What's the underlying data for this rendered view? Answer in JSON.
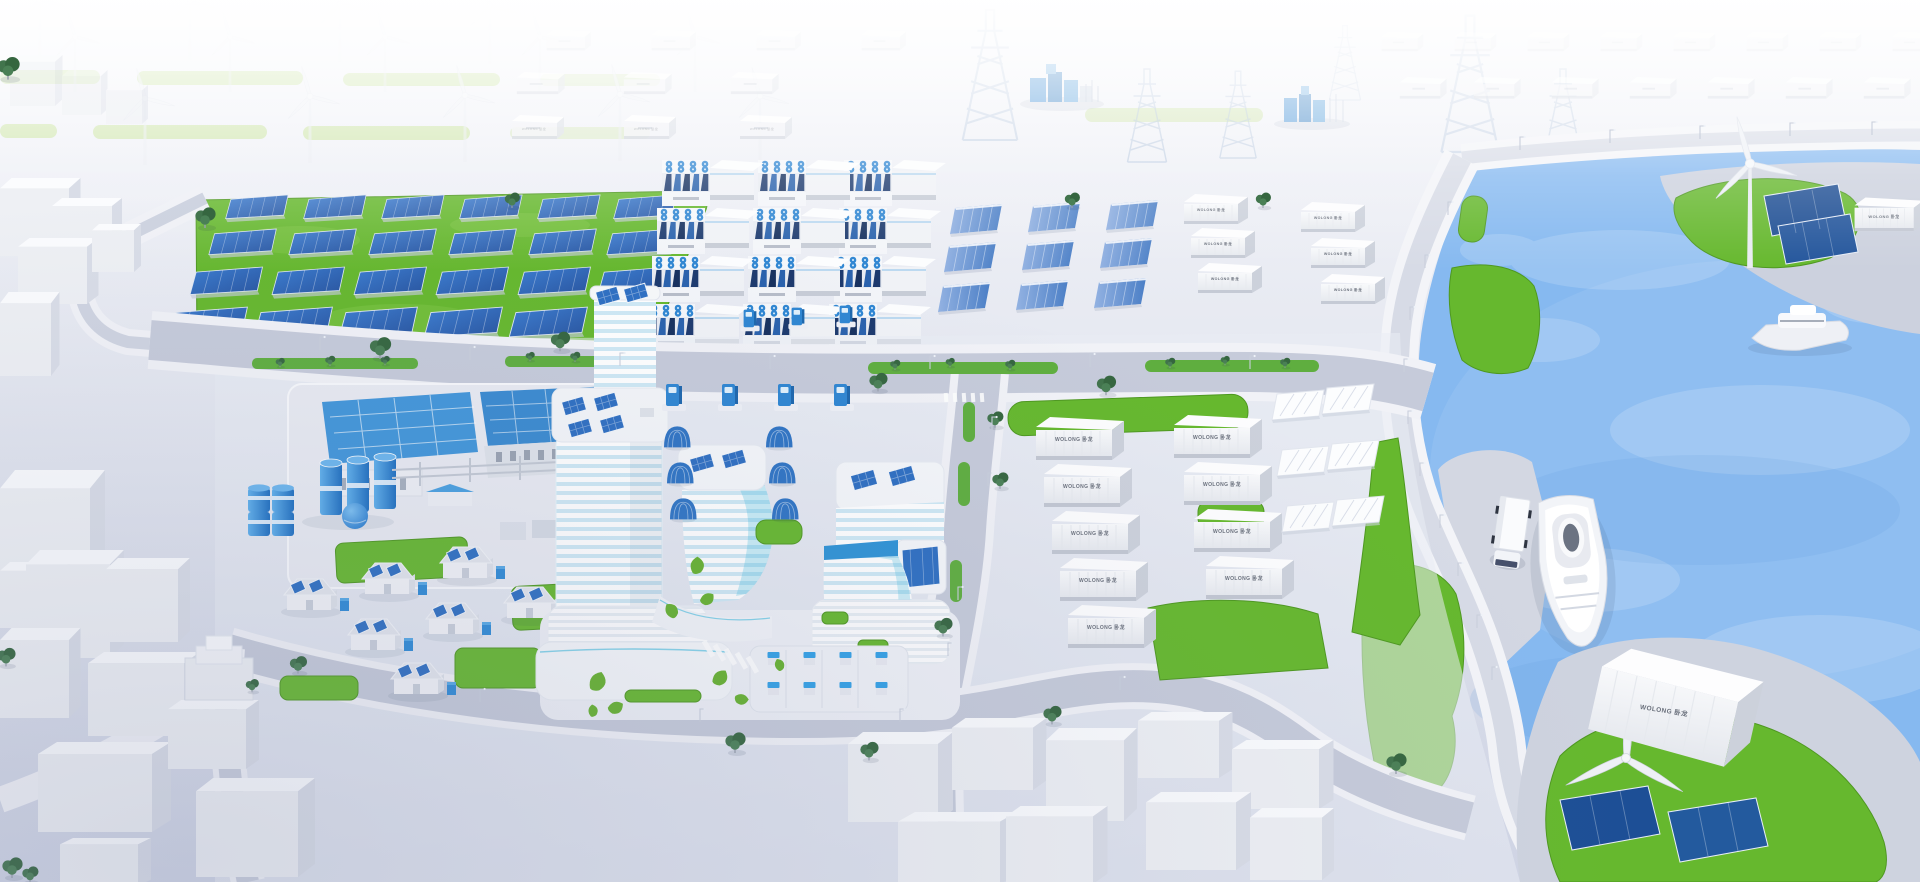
{
  "meta": {
    "alt": "Isometric 3D rendering of a coastal zero-carbon smart energy city with wind, solar, battery storage, a riverside campus and islands"
  },
  "brand": {
    "label": "WOLONG 卧龙"
  },
  "palette": {
    "water": "#86b9f0",
    "water_light": "#aacef7",
    "grass": "#66b82e",
    "grass_dark": "#4e9820",
    "grass_faded": "#cfe5ad",
    "ground_top": "#f5f6fa",
    "ground_bottom": "#d2d7e6",
    "road": "#c6cbda",
    "sidewalk": "#f1f2f7",
    "panel": "#2f6fc2",
    "panel_dark": "#1d4f94",
    "navy_module": "#1d3a6e",
    "accent_blue": "#2f86d2",
    "accent_cyan": "#49c0e0",
    "white_structure": "#f2f3f7",
    "structure_shade": "#d9dde7",
    "label_text": "#6a707c",
    "tree_green": "#3a6b45"
  },
  "zones": [
    {
      "id": "wind-farm",
      "label": "Wind turbine field"
    },
    {
      "id": "distant-container-rows",
      "label": "Hazy storage container rows"
    },
    {
      "id": "transmission",
      "label": "Transmission pylons and substations"
    },
    {
      "id": "solar-farm",
      "label": "Ground-mounted solar farm"
    },
    {
      "id": "battery-storage",
      "label": "Battery energy storage stacks"
    },
    {
      "id": "inverter-racks",
      "label": "Blue inverter rack rows"
    },
    {
      "id": "container-yard",
      "label": "WOLONG container yard"
    },
    {
      "id": "white-racks",
      "label": "White rack units"
    },
    {
      "id": "industrial-plant",
      "label": "Industrial plant with tanks"
    },
    {
      "id": "solar-houses",
      "label": "Houses with rooftop solar"
    },
    {
      "id": "campus",
      "label": "Striped office campus with rooftop solar"
    },
    {
      "id": "ev-charging",
      "label": "EV chargers and solar carports"
    },
    {
      "id": "parking",
      "label": "Charging parking lot"
    },
    {
      "id": "roads",
      "label": "City roads with green medians"
    },
    {
      "id": "waterfront",
      "label": "Waterfront promenade"
    },
    {
      "id": "river",
      "label": "River with ships"
    },
    {
      "id": "north-island",
      "label": "North island with turbine, panels, container"
    },
    {
      "id": "south-island",
      "label": "South island with turbine, panels, container"
    },
    {
      "id": "city-blocks",
      "label": "White low-poly city blocks"
    }
  ]
}
